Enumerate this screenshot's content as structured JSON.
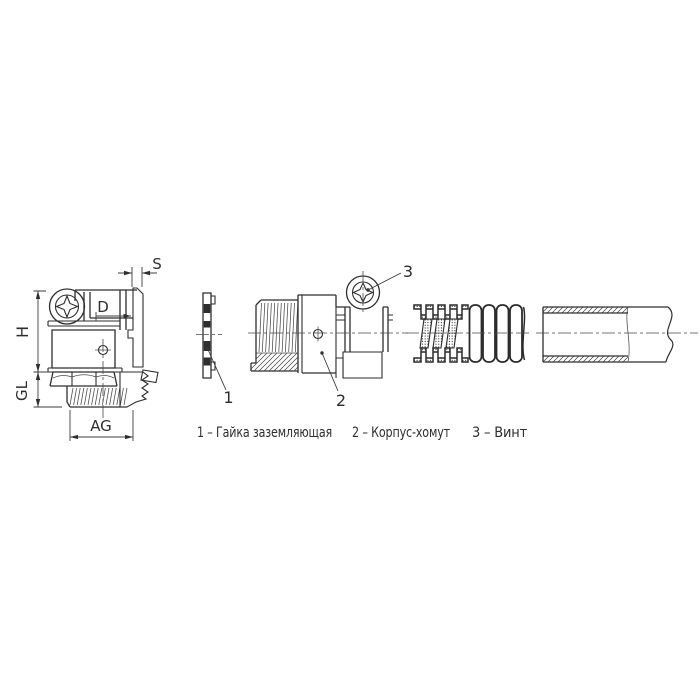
{
  "drawing": {
    "background": "#ffffff",
    "line_color": "#2e2e2e",
    "dimensions": {
      "s": "S",
      "d": "D",
      "h": "H",
      "gl": "GL",
      "ag": "AG"
    },
    "callouts": {
      "item1": "1",
      "item2": "2",
      "item3": "3"
    },
    "legend": {
      "items": [
        {
          "text": "1 – Гайка заземляющая"
        },
        {
          "text": "2 – Корпус-хомут"
        },
        {
          "text": "3 – Винт"
        }
      ]
    }
  }
}
